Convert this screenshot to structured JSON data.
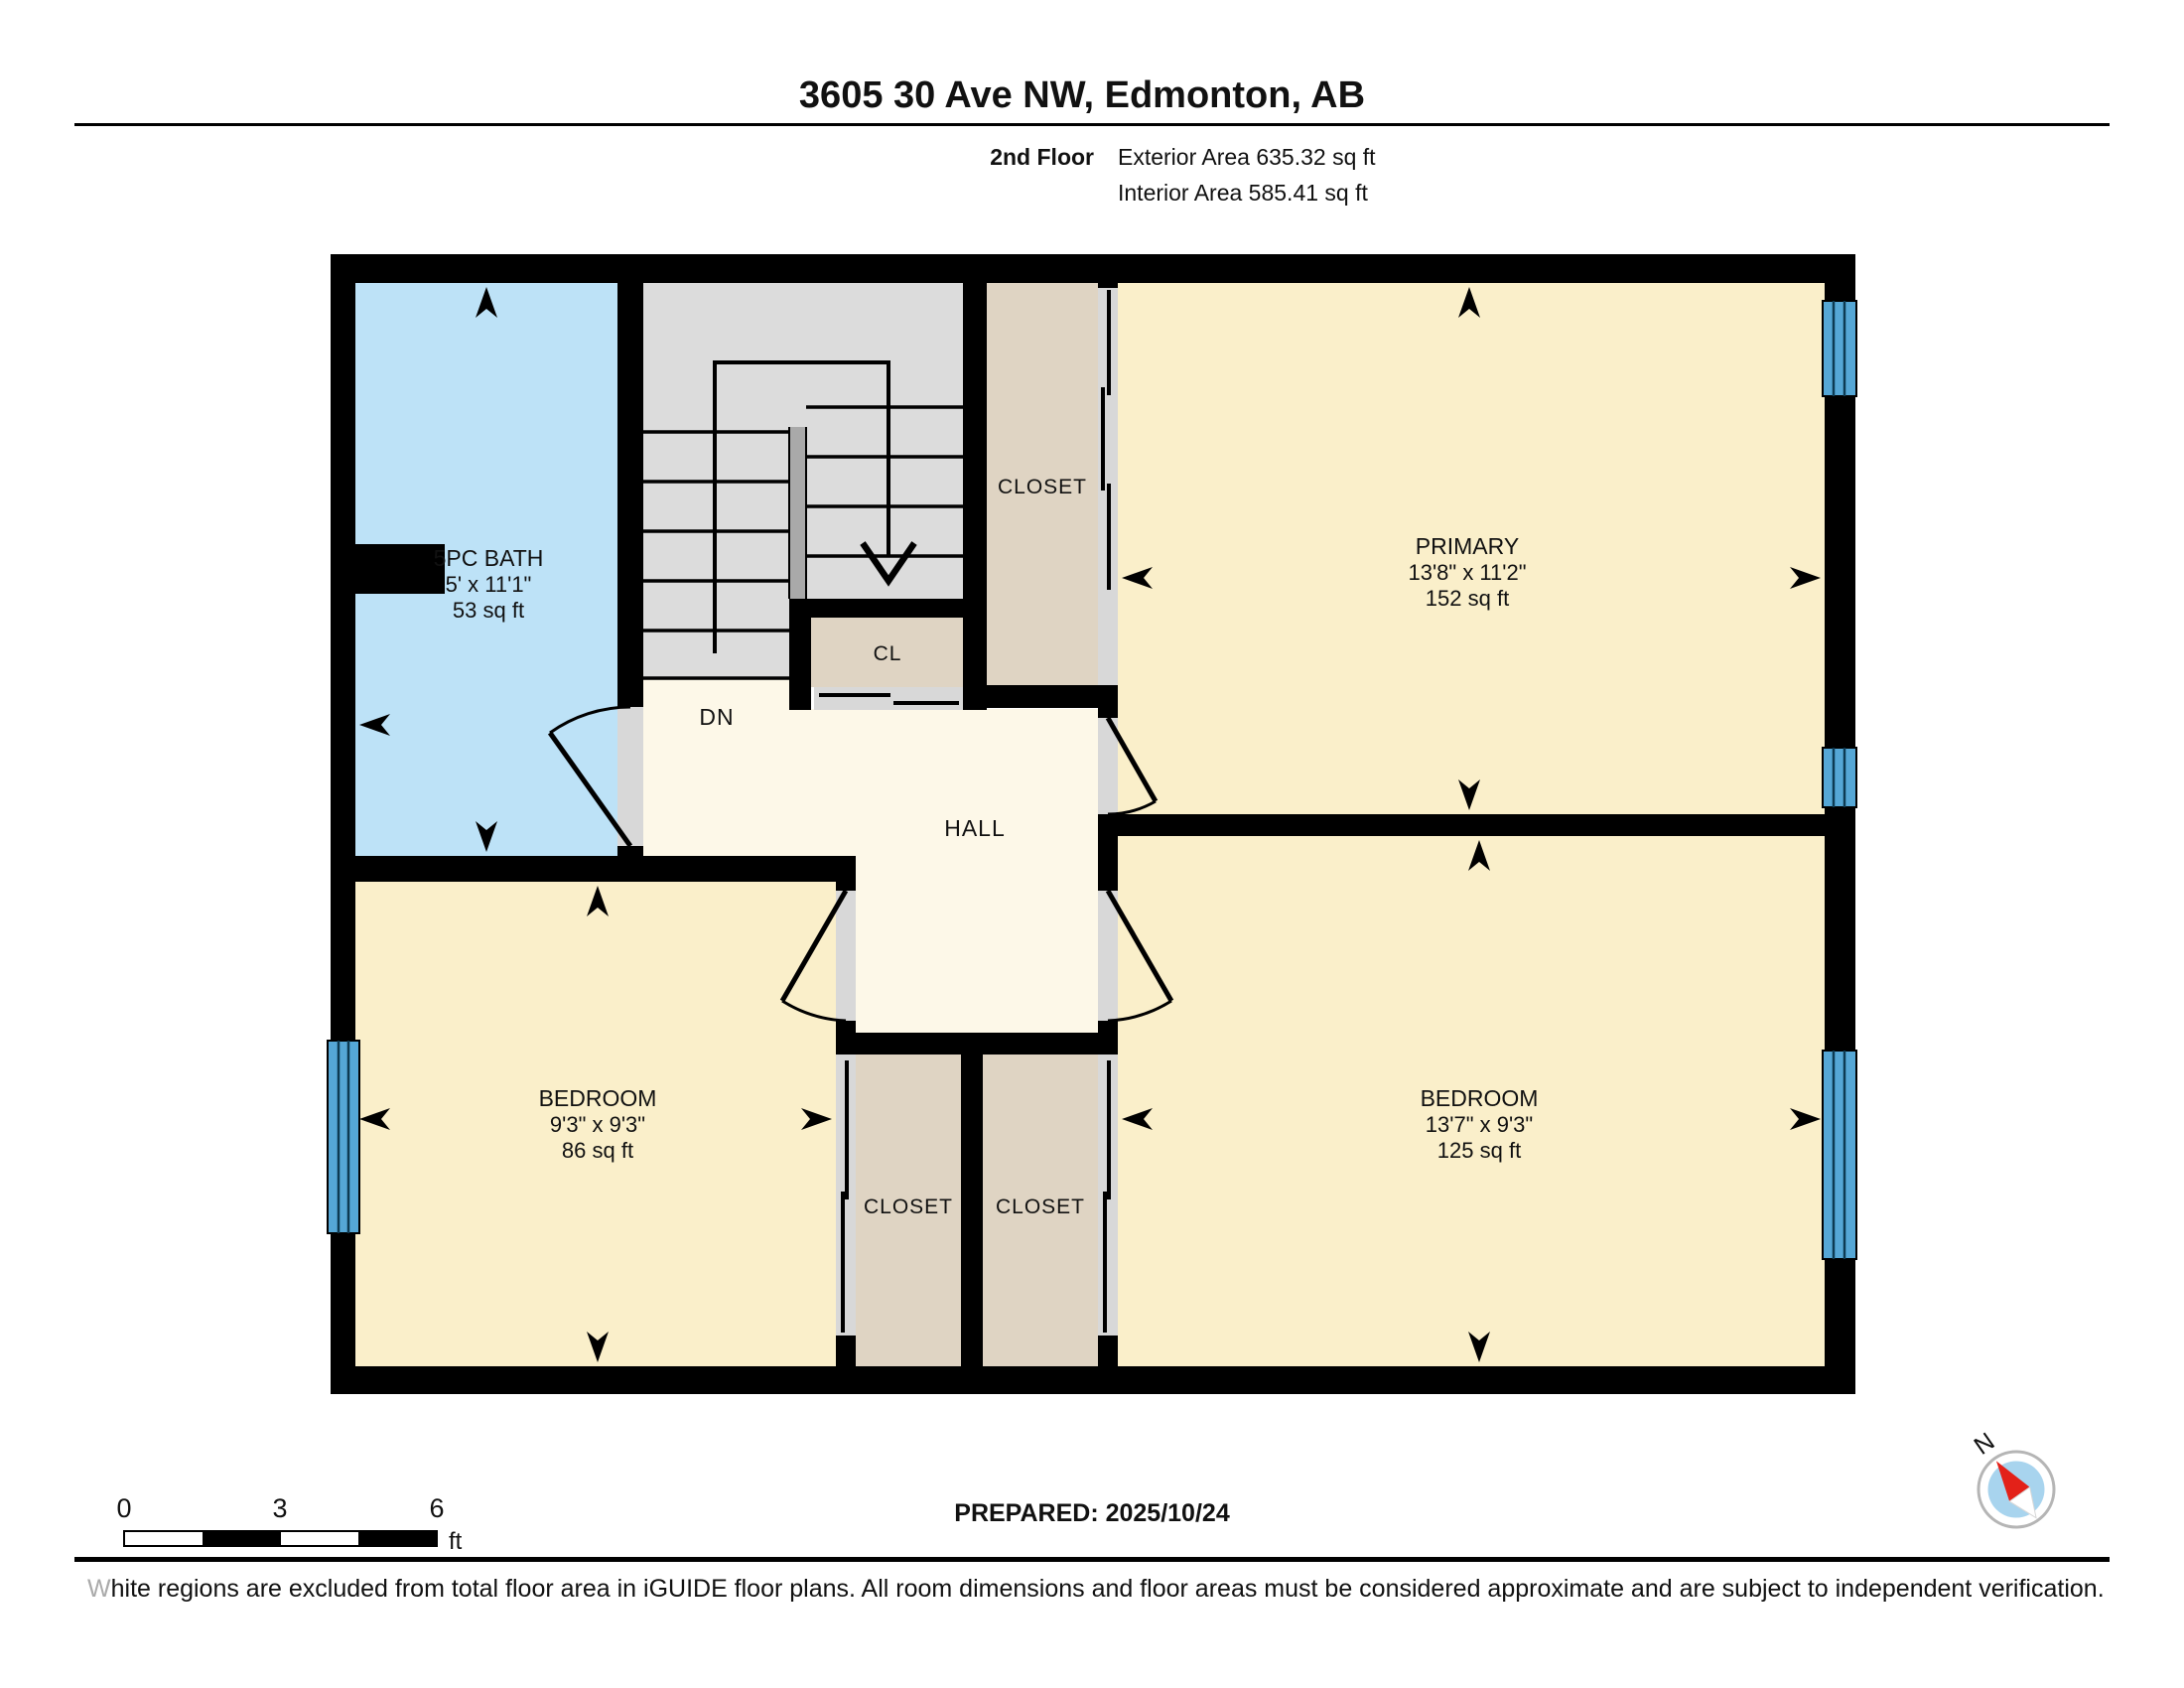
{
  "header": {
    "title": "3605 30 Ave NW, Edmonton, AB",
    "floor_label": "2nd Floor",
    "exterior_area": "Exterior Area 635.32 sq ft",
    "interior_area": "Interior Area 585.41 sq ft"
  },
  "rooms": {
    "bath": {
      "name": "5PC BATH",
      "dims": "5' x 11'1\"",
      "area": "53 sq ft"
    },
    "primary": {
      "name": "PRIMARY",
      "dims": "13'8\" x 11'2\"",
      "area": "152 sq ft"
    },
    "bedroom_left": {
      "name": "BEDROOM",
      "dims": "9'3\" x 9'3\"",
      "area": "86 sq ft"
    },
    "bedroom_right": {
      "name": "BEDROOM",
      "dims": "13'7\" x 9'3\"",
      "area": "125 sq ft"
    },
    "closet_top": {
      "name": "CLOSET"
    },
    "closet_left": {
      "name": "CLOSET"
    },
    "closet_right": {
      "name": "CLOSET"
    },
    "closet_small": {
      "name": "CL"
    },
    "hall": {
      "name": "HALL"
    },
    "stairs": {
      "direction_label": "DN"
    }
  },
  "scale_bar": {
    "tick_labels": [
      "0",
      "3",
      "6"
    ],
    "unit": "ft"
  },
  "compass": {
    "north_label": "N"
  },
  "footer": {
    "prepared": "PREPARED: 2025/10/24",
    "disclaimer_first_letter": "W",
    "disclaimer_rest": "hite regions are excluded from total floor area in iGUIDE floor plans. All room dimensions and floor areas must be considered approximate and are subject to independent verification."
  },
  "colors": {
    "wall": "#000000",
    "bath": "#BDE2F7",
    "stairs": "#DCDCDC",
    "stair_rail": "#A9A9A9",
    "closet": "#DFD4C3",
    "bedroom": "#FAEFCA",
    "hall": "#FDF8E8",
    "door": "#D8D8D8",
    "window": "#55A7D6",
    "compass_inner": "#A8D4EE",
    "compass_needle": "#E32119"
  }
}
